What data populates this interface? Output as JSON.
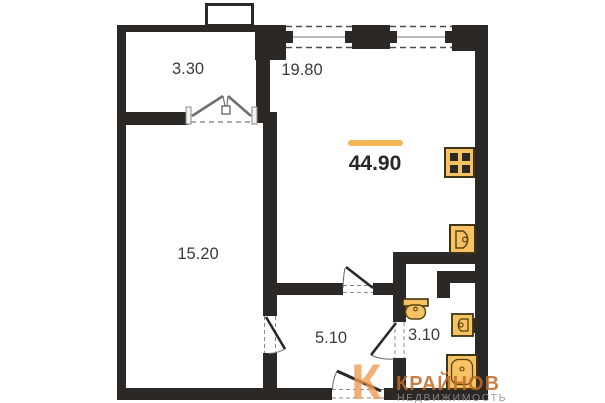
{
  "plan": {
    "type": "apartment-floor-plan",
    "total_area": "44.90",
    "rooms": [
      {
        "id": "balcony",
        "area": "3.30"
      },
      {
        "id": "living-kitchen",
        "area": "19.80"
      },
      {
        "id": "bedroom",
        "area": "15.20"
      },
      {
        "id": "hallway",
        "area": "5.10"
      },
      {
        "id": "bathroom",
        "area": "3.10"
      }
    ],
    "fixtures": [
      "stove",
      "kitchen-sink",
      "toilet",
      "washbasin",
      "bathtub"
    ],
    "colors": {
      "wall": "#2b2826",
      "fixture_fill": "#f7c261",
      "fixture_stroke": "#55420f",
      "accent_orange": "#f2b755"
    }
  },
  "watermark": {
    "logo_letter": "К",
    "brand": "КРАЙНОВ",
    "tagline": "НЕДВИЖИМОСТЬ"
  }
}
